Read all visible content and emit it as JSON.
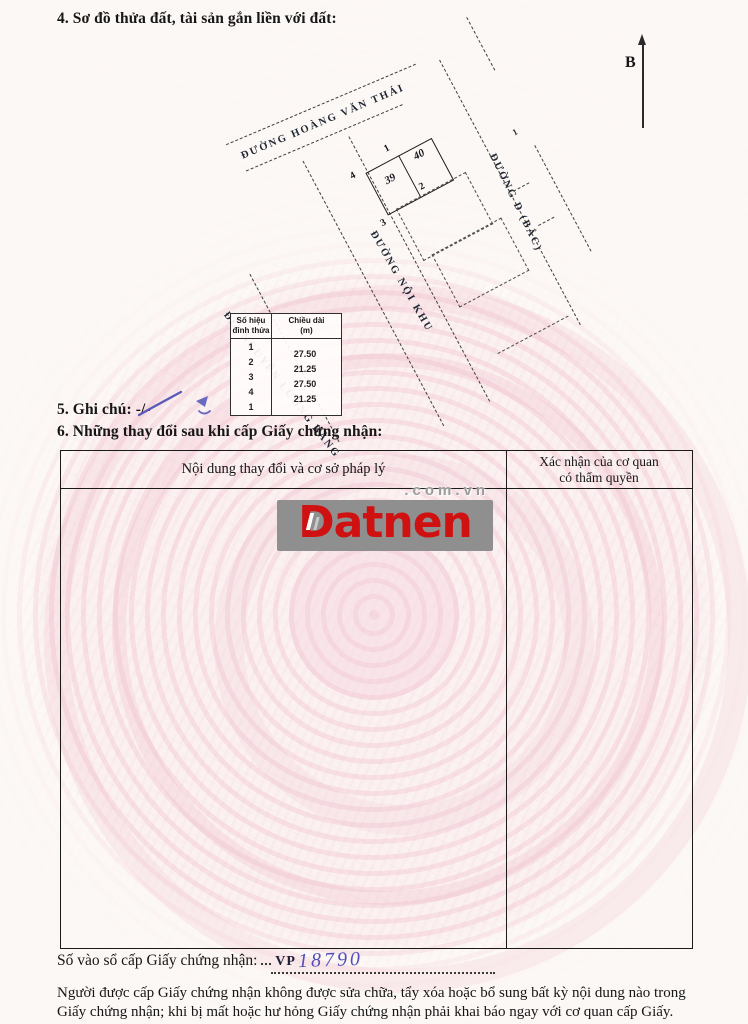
{
  "sections": {
    "s4_title": "4. Sơ đồ thửa đất, tài sản gắn liền với đất:",
    "s5_title": "5. Ghi chú: -/-",
    "s6_title": "6. Những thay đổi sau khi cấp Giấy chứng nhận:"
  },
  "map": {
    "north_label": "B",
    "road_top": "ĐƯỜNG HOÀNG VĂN THÁI",
    "road_left": "ĐL. NGUYỄN LƯƠNG BẰNG",
    "road_inner": "ĐƯỜNG NỘI KHU",
    "road_right": "ĐƯỜNG D (BẮC)",
    "lot_left": "39",
    "lot_right": "40",
    "v1": "1",
    "v2": "2",
    "v3": "3",
    "v4": "4",
    "stray_label": "1"
  },
  "vertex_table": {
    "h1a": "Số hiệu",
    "h1b": "đỉnh thửa",
    "h2a": "Chiều dài",
    "h2b": "(m)",
    "vertices": [
      "1",
      "2",
      "3",
      "4",
      "1"
    ],
    "lengths": [
      "27.50",
      "21.25",
      "27.50",
      "21.25"
    ]
  },
  "changes_table": {
    "col1_header": "Nội dung thay đổi và cơ sở pháp lý",
    "col2_line1": "Xác nhận của cơ quan",
    "col2_line2": "có thẩm quyền"
  },
  "watermark": {
    "brand": "Datnen",
    "suffix": ".com.vn"
  },
  "registry": {
    "label": "Số vào sổ cấp Giấy chứng nhận:",
    "prefix": "VP",
    "number": "18790"
  },
  "footer": {
    "text": "Người được cấp Giấy chứng nhận không được sửa chữa, tẩy xóa hoặc bổ sung bất kỳ nội dung nào trong Giấy chứng nhận; khi bị mất hoặc hư hỏng Giấy chứng nhận phải khai báo ngay với cơ quan cấp Giấy."
  },
  "colors": {
    "accent_red": "#d01111",
    "logo_gray": "#8f8f8f",
    "ink_blue": "#5050b8",
    "pattern_pink": "#f1c4d1"
  }
}
